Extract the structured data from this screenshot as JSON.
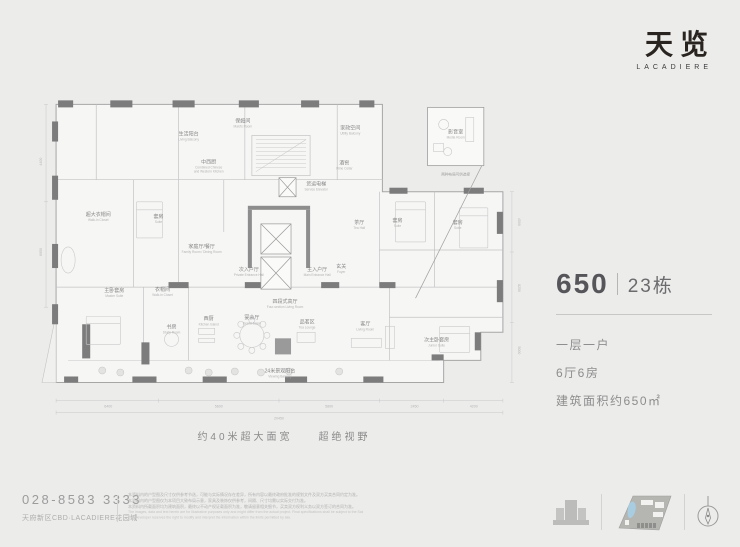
{
  "colors": {
    "page_bg": "#ECECEB",
    "ink_dark": "#29241F",
    "wall_gray": "#7C7C7C",
    "text_gray": "#8D8D8D",
    "map_blue": "#A9CDE0"
  },
  "logo": {
    "name": "天览",
    "sub": "LACADIERE"
  },
  "plan": {
    "caption": "约40米超大面宽　　超绝视野",
    "callout_note": "两种布局可供选择",
    "rooms": [
      {
        "cn": "生活阳台",
        "en": "Living Balcony",
        "x": 150,
        "y": 44
      },
      {
        "cn": "保姆间",
        "en": "Maid's Room",
        "x": 204,
        "y": 31
      },
      {
        "cn": "家政空间",
        "en": "Utility Balcony",
        "x": 311,
        "y": 38
      },
      {
        "cn": "中西厨",
        "en": "Combined Chinese",
        "en2": "and Western Kitchen",
        "x": 170,
        "y": 72
      },
      {
        "cn": "酒窖",
        "en": "Wine Cellar",
        "x": 305,
        "y": 73
      },
      {
        "cn": "货运电梯",
        "en": "Service Elevator",
        "x": 277,
        "y": 94
      },
      {
        "cn": "超大衣帽间",
        "en": "Walk-in Closet",
        "x": 60,
        "y": 124
      },
      {
        "cn": "套房",
        "en": "Suite",
        "x": 120,
        "y": 126
      },
      {
        "cn": "家庭厅/餐厅",
        "en": "Family Room / Dining Room",
        "x": 163,
        "y": 156
      },
      {
        "cn": "茶厅",
        "en": "Tea Hall",
        "x": 320,
        "y": 132
      },
      {
        "cn": "套房",
        "en": "Suite",
        "x": 358,
        "y": 130
      },
      {
        "cn": "套房",
        "en": "Suite",
        "x": 418,
        "y": 132
      },
      {
        "cn": "玄关",
        "en": "Foyer",
        "x": 302,
        "y": 176
      },
      {
        "cn": "次入户厅",
        "en": "Private Entrance Hall",
        "x": 210,
        "y": 179
      },
      {
        "cn": "主入户厅",
        "en": "Main Entrance Hall",
        "x": 278,
        "y": 179
      },
      {
        "cn": "主卧套房",
        "en": "Master Suite",
        "x": 76,
        "y": 200
      },
      {
        "cn": "衣帽间",
        "en": "Walk-in Closet",
        "x": 124,
        "y": 199
      },
      {
        "cn": "书房",
        "en": "Study Room",
        "x": 133,
        "y": 236
      },
      {
        "cn": "西厨",
        "en": "Kitchen Island",
        "x": 170,
        "y": 228
      },
      {
        "cn": "四段式高厅",
        "en": "Four-section Living Room",
        "x": 246,
        "y": 211
      },
      {
        "cn": "宴会厅",
        "en": "Grand Salon",
        "x": 213,
        "y": 227
      },
      {
        "cn": "品茗区",
        "en": "Tea Lounge",
        "x": 268,
        "y": 231
      },
      {
        "cn": "客厅",
        "en": "Living Room",
        "x": 326,
        "y": 233
      },
      {
        "cn": "24米景观阳台",
        "en": "Viewing Balcony",
        "x": 241,
        "y": 280
      },
      {
        "cn": "次主卧套房",
        "en": "Junior Suite",
        "x": 397,
        "y": 249
      },
      {
        "cn": "影音室",
        "en": "Media Room",
        "x": 416,
        "y": 42
      }
    ],
    "dims_bottom": [
      {
        "t": "6400",
        "x": 70
      },
      {
        "t": "5600",
        "x": 180
      },
      {
        "t": "5800",
        "x": 290
      },
      {
        "t": "2450",
        "x": 375
      },
      {
        "t": "4200",
        "x": 434
      }
    ],
    "dims_total": {
      "t": "20450",
      "x": 240
    },
    "dims_right": [
      {
        "t": "4500",
        "y": 130
      },
      {
        "t": "8250",
        "y": 196
      },
      {
        "t": "5000",
        "y": 258
      }
    ],
    "dims_left": [
      {
        "t": "4400",
        "y": 70
      },
      {
        "t": "6950",
        "y": 160
      }
    ]
  },
  "info": {
    "number": "650",
    "building": "23栋",
    "lines": [
      "一层一户",
      "6厅6房",
      "建筑面积约650㎡"
    ]
  },
  "footer": {
    "phone": "028-8583 3333",
    "address": "天府新区CBD·LACADIERE花园城",
    "disclaimer_cn": [
      "本资料内的户型图及尺寸仅供参考节选，可能与实际情况存在差异，所有内容以最终政府批准的规划文件及双方买卖合同约定为准。",
      "本资料内的户型图仅为本项目大致布局示意，家具及装饰仅供参考，间隔、尺寸均需以实际交付为准。",
      "本资料内所载面积均为建筑面积，最终以不动产权证载面积为准，敬请留意相关细节，买卖双方权利义务以双方签订的合同为准。"
    ],
    "disclaimer_en": [
      "The images, data and text herein are for illustrative purposes only and might differ from the actual project. Final specifications shall be subject to the Sales Contract.",
      "The Developer reserves the right to modify and interpret the information within the limits permitted by law."
    ],
    "icons": [
      "building-icon",
      "siteplan-icon",
      "compass-icon"
    ]
  }
}
